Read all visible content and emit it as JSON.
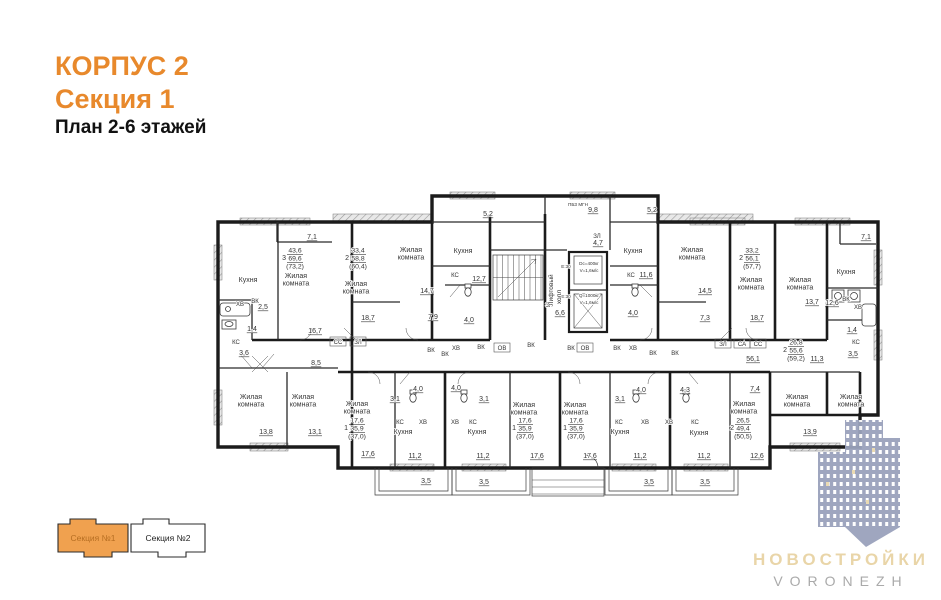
{
  "title": {
    "building": "КОРПУС 2",
    "section": "Секция 1",
    "plan": "План 2-6 этажей"
  },
  "legend": {
    "section1": "Секция №1",
    "section2": "Секция №2"
  },
  "logo": {
    "title": "НОВОСТРОЙКИ",
    "subtitle": "VORONEZH"
  },
  "colors": {
    "accent_orange": "#E8892C",
    "legend_fill": "#F0A14F",
    "legend_text": "#B66E22",
    "wall": "#1B1B1B",
    "label": "#333333",
    "logo_building": "#9AA2BC",
    "logo_title": "#E8D3A4",
    "logo_subtitle": "#A6A6A6"
  },
  "plan": {
    "labels": [
      {
        "t": "Кухня",
        "x": 248,
        "y": 282,
        "k": "r"
      },
      {
        "t": "Жилая|комната",
        "x": 296,
        "y": 278,
        "k": "r"
      },
      {
        "t": "Жилая|комната",
        "x": 356,
        "y": 286,
        "k": "r"
      },
      {
        "t": "Жилая|комната",
        "x": 411,
        "y": 252,
        "k": "r"
      },
      {
        "t": "Кухня",
        "x": 463,
        "y": 253,
        "k": "r"
      },
      {
        "t": "Кухня",
        "x": 633,
        "y": 253,
        "k": "r"
      },
      {
        "t": "Жилая|комната",
        "x": 692,
        "y": 252,
        "k": "r"
      },
      {
        "t": "Жилая|комната",
        "x": 751,
        "y": 282,
        "k": "r"
      },
      {
        "t": "Жилая|комната",
        "x": 800,
        "y": 282,
        "k": "r"
      },
      {
        "t": "Кухня",
        "x": 846,
        "y": 274,
        "k": "r"
      },
      {
        "t": "Жилая|комната",
        "x": 251,
        "y": 399,
        "k": "r"
      },
      {
        "t": "Жилая|комната",
        "x": 303,
        "y": 399,
        "k": "r"
      },
      {
        "t": "Жилая|комната",
        "x": 357,
        "y": 406,
        "k": "r"
      },
      {
        "t": "Кухня",
        "x": 403,
        "y": 434,
        "k": "r"
      },
      {
        "t": "Кухня",
        "x": 477,
        "y": 434,
        "k": "r"
      },
      {
        "t": "Жилая|комната",
        "x": 524,
        "y": 407,
        "k": "r"
      },
      {
        "t": "Жилая|комната",
        "x": 575,
        "y": 407,
        "k": "r"
      },
      {
        "t": "Кухня",
        "x": 620,
        "y": 434,
        "k": "r"
      },
      {
        "t": "Кухня",
        "x": 699,
        "y": 435,
        "k": "r"
      },
      {
        "t": "Жилая|комната",
        "x": 744,
        "y": 406,
        "k": "r"
      },
      {
        "t": "Жилая|комната",
        "x": 797,
        "y": 399,
        "k": "r"
      },
      {
        "t": "Жилая|комната",
        "x": 851,
        "y": 399,
        "k": "r"
      },
      {
        "t": "7,1",
        "x": 312,
        "y": 239,
        "k": "d"
      },
      {
        "t": "2,5",
        "x": 263,
        "y": 309,
        "k": "d"
      },
      {
        "t": "1,4",
        "x": 252,
        "y": 331,
        "k": "d"
      },
      {
        "t": "3,6",
        "x": 244,
        "y": 355,
        "k": "d"
      },
      {
        "t": "16,7",
        "x": 315,
        "y": 333,
        "k": "d"
      },
      {
        "t": "8,5",
        "x": 316,
        "y": 365,
        "k": "d"
      },
      {
        "t": "18,7",
        "x": 368,
        "y": 320,
        "k": "d"
      },
      {
        "t": "7,9",
        "x": 433,
        "y": 319,
        "k": "d"
      },
      {
        "t": "14,7",
        "x": 427,
        "y": 293,
        "k": "d"
      },
      {
        "t": "12,7",
        "x": 479,
        "y": 281,
        "k": "d"
      },
      {
        "t": "5,2",
        "x": 488,
        "y": 216,
        "k": "d"
      },
      {
        "t": "4,0",
        "x": 469,
        "y": 322,
        "k": "d"
      },
      {
        "t": "9,8",
        "x": 593,
        "y": 212,
        "k": "d"
      },
      {
        "t": "4,7",
        "x": 598,
        "y": 245,
        "k": "d"
      },
      {
        "t": "6,6",
        "x": 560,
        "y": 315,
        "k": "d"
      },
      {
        "t": "5,2",
        "x": 652,
        "y": 212,
        "k": "d"
      },
      {
        "t": "11,6",
        "x": 646,
        "y": 277,
        "k": "d"
      },
      {
        "t": "4,0",
        "x": 633,
        "y": 315,
        "k": "d"
      },
      {
        "t": "14,5",
        "x": 705,
        "y": 293,
        "k": "d"
      },
      {
        "t": "7,3",
        "x": 705,
        "y": 320,
        "k": "d"
      },
      {
        "t": "18,7",
        "x": 757,
        "y": 320,
        "k": "d"
      },
      {
        "t": "7,1",
        "x": 866,
        "y": 239,
        "k": "d"
      },
      {
        "t": "13,7",
        "x": 812,
        "y": 304,
        "k": "d"
      },
      {
        "t": "12,6",
        "x": 832,
        "y": 305,
        "k": "d"
      },
      {
        "t": "1,4",
        "x": 852,
        "y": 332,
        "k": "d"
      },
      {
        "t": "3,5",
        "x": 853,
        "y": 356,
        "k": "d"
      },
      {
        "t": "11,3",
        "x": 817,
        "y": 361,
        "k": "d"
      },
      {
        "t": "56,1",
        "x": 753,
        "y": 361,
        "k": "d"
      },
      {
        "t": "7,4",
        "x": 755,
        "y": 391,
        "k": "d"
      },
      {
        "t": "13,8",
        "x": 266,
        "y": 434,
        "k": "d"
      },
      {
        "t": "13,1",
        "x": 315,
        "y": 434,
        "k": "d"
      },
      {
        "t": "17,6",
        "x": 368,
        "y": 456,
        "k": "d"
      },
      {
        "t": "11,2",
        "x": 415,
        "y": 458,
        "k": "d"
      },
      {
        "t": "3,5",
        "x": 426,
        "y": 483,
        "k": "d"
      },
      {
        "t": "4,0",
        "x": 418,
        "y": 391,
        "k": "d"
      },
      {
        "t": "3,1",
        "x": 395,
        "y": 401,
        "k": "d"
      },
      {
        "t": "4,0",
        "x": 456,
        "y": 390,
        "k": "d"
      },
      {
        "t": "3,1",
        "x": 484,
        "y": 401,
        "k": "d"
      },
      {
        "t": "17,6",
        "x": 537,
        "y": 458,
        "k": "d"
      },
      {
        "t": "17,6",
        "x": 590,
        "y": 458,
        "k": "d"
      },
      {
        "t": "11,2",
        "x": 483,
        "y": 458,
        "k": "d"
      },
      {
        "t": "11,2",
        "x": 640,
        "y": 458,
        "k": "d"
      },
      {
        "t": "3,5",
        "x": 484,
        "y": 484,
        "k": "d"
      },
      {
        "t": "3,5",
        "x": 649,
        "y": 484,
        "k": "d"
      },
      {
        "t": "4,0",
        "x": 641,
        "y": 392,
        "k": "d"
      },
      {
        "t": "3,1",
        "x": 620,
        "y": 401,
        "k": "d"
      },
      {
        "t": "4,3",
        "x": 685,
        "y": 392,
        "k": "d"
      },
      {
        "t": "11,2",
        "x": 704,
        "y": 458,
        "k": "d"
      },
      {
        "t": "12,6",
        "x": 757,
        "y": 458,
        "k": "d"
      },
      {
        "t": "3,5",
        "x": 705,
        "y": 484,
        "k": "d"
      },
      {
        "t": "13,9",
        "x": 810,
        "y": 434,
        "k": "d"
      },
      {
        "t": "ХВ",
        "x": 240,
        "y": 306,
        "k": "t"
      },
      {
        "t": "ВК",
        "x": 255,
        "y": 303,
        "k": "t"
      },
      {
        "t": "КС",
        "x": 236,
        "y": 344,
        "k": "t"
      },
      {
        "t": "ВК",
        "x": 431,
        "y": 352,
        "k": "t"
      },
      {
        "t": "ХВ",
        "x": 456,
        "y": 350,
        "k": "t"
      },
      {
        "t": "ВК",
        "x": 445,
        "y": 356,
        "k": "t"
      },
      {
        "t": "ВК",
        "x": 481,
        "y": 349,
        "k": "t"
      },
      {
        "t": "ВК",
        "x": 531,
        "y": 347,
        "k": "t"
      },
      {
        "t": "ВК",
        "x": 571,
        "y": 350,
        "k": "t"
      },
      {
        "t": "ВК",
        "x": 617,
        "y": 350,
        "k": "t"
      },
      {
        "t": "ХВ",
        "x": 633,
        "y": 350,
        "k": "t"
      },
      {
        "t": "ВК",
        "x": 653,
        "y": 355,
        "k": "t"
      },
      {
        "t": "ВК",
        "x": 675,
        "y": 355,
        "k": "t"
      },
      {
        "t": "КС",
        "x": 455,
        "y": 277,
        "k": "t"
      },
      {
        "t": "КС",
        "x": 631,
        "y": 277,
        "k": "t"
      },
      {
        "t": "ВК",
        "x": 846,
        "y": 301,
        "k": "t"
      },
      {
        "t": "ХВ",
        "x": 858,
        "y": 309,
        "k": "t"
      },
      {
        "t": "КС",
        "x": 856,
        "y": 344,
        "k": "t"
      },
      {
        "t": "КС",
        "x": 400,
        "y": 424,
        "k": "t"
      },
      {
        "t": "ХВ",
        "x": 423,
        "y": 424,
        "k": "t"
      },
      {
        "t": "ХВ",
        "x": 455,
        "y": 424,
        "k": "t"
      },
      {
        "t": "КС",
        "x": 473,
        "y": 424,
        "k": "t"
      },
      {
        "t": "КС",
        "x": 619,
        "y": 424,
        "k": "t"
      },
      {
        "t": "ХВ",
        "x": 645,
        "y": 424,
        "k": "t"
      },
      {
        "t": "ХВ",
        "x": 669,
        "y": 424,
        "k": "t"
      },
      {
        "t": "КС",
        "x": 695,
        "y": 424,
        "k": "t"
      },
      {
        "t": "ЗЛ",
        "x": 597,
        "y": 238,
        "k": "t"
      },
      {
        "t": "ЗЛ",
        "x": 549,
        "y": 307,
        "k": "t"
      },
      {
        "t": "СС",
        "x": 338,
        "y": 344,
        "k": "b"
      },
      {
        "t": "ЗЛ",
        "x": 358,
        "y": 344,
        "k": "b"
      },
      {
        "t": "ОВ",
        "x": 502,
        "y": 350,
        "k": "b"
      },
      {
        "t": "ОВ",
        "x": 585,
        "y": 350,
        "k": "b"
      },
      {
        "t": "ЗЛ",
        "x": 723,
        "y": 346,
        "k": "b"
      },
      {
        "t": "СА",
        "x": 742,
        "y": 346,
        "k": "b"
      },
      {
        "t": "СС",
        "x": 758,
        "y": 346,
        "k": "b"
      },
      {
        "t": "ПБЗ МГН",
        "x": 578,
        "y": 206,
        "k": "y"
      },
      {
        "t": "Е:30",
        "x": 566,
        "y": 268,
        "k": "y"
      },
      {
        "t": "Е:30",
        "x": 566,
        "y": 298,
        "k": "y"
      },
      {
        "t": "Dс=400кг",
        "x": 589,
        "y": 265,
        "k": "y"
      },
      {
        "t": "V=1,6м/с",
        "x": 589,
        "y": 272,
        "k": "y"
      },
      {
        "t": "Q=1000кг",
        "x": 589,
        "y": 297,
        "k": "y"
      },
      {
        "t": "V=1,6м/с",
        "x": 589,
        "y": 304,
        "k": "y"
      },
      {
        "t": "Лифтовый",
        "x": 553,
        "y": 290,
        "k": "v"
      },
      {
        "t": "холл",
        "x": 561,
        "y": 297,
        "k": "v"
      }
    ],
    "specs": [
      {
        "n": "3",
        "top": "43,6",
        "mid": "69,6",
        "bot": "(73,2)",
        "x": 295,
        "y": 258
      },
      {
        "n": "2",
        "top": "33,4",
        "mid": "58,8",
        "bot": "(60,4)",
        "x": 358,
        "y": 258
      },
      {
        "n": "2",
        "top": "33,2",
        "mid": "56,1",
        "bot": "(57,7)",
        "x": 752,
        "y": 258
      },
      {
        "n": "2",
        "top": "26,8",
        "mid": "55,6",
        "bot": "(59,2)",
        "x": 796,
        "y": 350
      },
      {
        "n": "1",
        "top": "17,6",
        "mid": "35,9",
        "bot": "(37,0)",
        "x": 357,
        "y": 428
      },
      {
        "n": "1",
        "top": "17,6",
        "mid": "35,9",
        "bot": "(37,0)",
        "x": 525,
        "y": 428
      },
      {
        "n": "1",
        "top": "17,6",
        "mid": "35,9",
        "bot": "(37,0)",
        "x": 576,
        "y": 428
      },
      {
        "n": "2",
        "top": "26,5",
        "mid": "49,4",
        "bot": "(50,5)",
        "x": 743,
        "y": 428
      }
    ]
  }
}
